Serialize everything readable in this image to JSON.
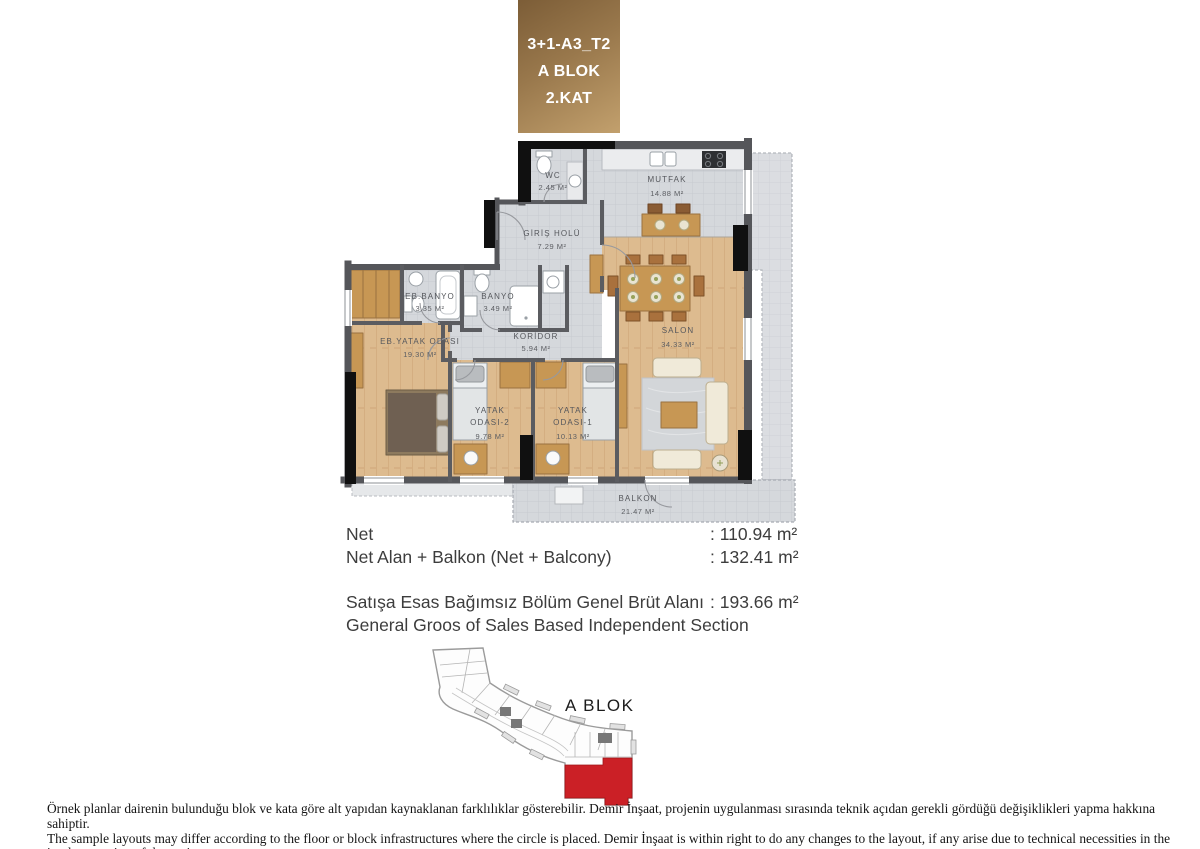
{
  "header": {
    "line1": "3+1-A3_T2",
    "line2": "A BLOK",
    "line3": "2.KAT"
  },
  "floor_plan": {
    "rooms": {
      "wc": {
        "name": "WC",
        "area": "2.45 M²"
      },
      "mutfak": {
        "name": "MUTFAK",
        "area": "14.88 M²"
      },
      "giris_holu": {
        "name": "GİRİŞ HOLÜ",
        "area": "7.29 M²"
      },
      "eb_banyo": {
        "name": "EB.BANYO",
        "area": "3.35 M²"
      },
      "banyo": {
        "name": "BANYO",
        "area": "3.49 M²"
      },
      "koridor": {
        "name": "KORİDOR",
        "area": "5.94 M²"
      },
      "eb_yatak_odasi": {
        "name": "EB.YATAK ODASI",
        "area": "19.30 M²"
      },
      "salon": {
        "name": "SALON",
        "area": "34.33 M²"
      },
      "yatak_odasi_2": {
        "name_line1": "YATAK",
        "name_line2": "ODASI-2",
        "area": "9.78 M²"
      },
      "yatak_odasi_1": {
        "name_line1": "YATAK",
        "name_line2": "ODASI-1",
        "area": "10.13 M²"
      },
      "balkon": {
        "name": "BALKON",
        "area": "21.47 M²"
      }
    }
  },
  "area_table": {
    "rows": [
      {
        "label": "Net",
        "value": ": 110.94 m²"
      },
      {
        "label": "Net Alan + Balkon (Net + Balcony)",
        "value": ": 132.41 m²"
      },
      {
        "label": "Satışa Esas Bağımsız Bölüm Genel Brüt Alanı",
        "value": ": 193.66 m²"
      },
      {
        "label": "General Groos of Sales Based Independent Section",
        "value": ""
      }
    ]
  },
  "site_plan": {
    "block_label": "A BLOK"
  },
  "footer": {
    "disclaimer_tr": "Örnek planlar dairenin bulunduğu blok ve kata göre alt yapıdan kaynaklanan farklılıklar gösterebilir. Demir İnşaat, projenin uygulanması sırasında teknik açıdan gerekli gördüğü değişiklikleri yapma hakkına sahiptir.",
    "disclaimer_en": "The sample layouts may differ according to the floor or block infrastructures where the circle is placed. Demir İnşaat is within right to do any changes to the layout, if any arise due to technical necessities in the implementation of the project."
  },
  "colors": {
    "header_brown_dark": "#7c5d37",
    "header_brown_light": "#c2a06d",
    "unit_red": "#cb2026",
    "wall": "#55565a",
    "tile_floor": "#d5d8dc",
    "wood_floor": "#ddbb8f"
  }
}
